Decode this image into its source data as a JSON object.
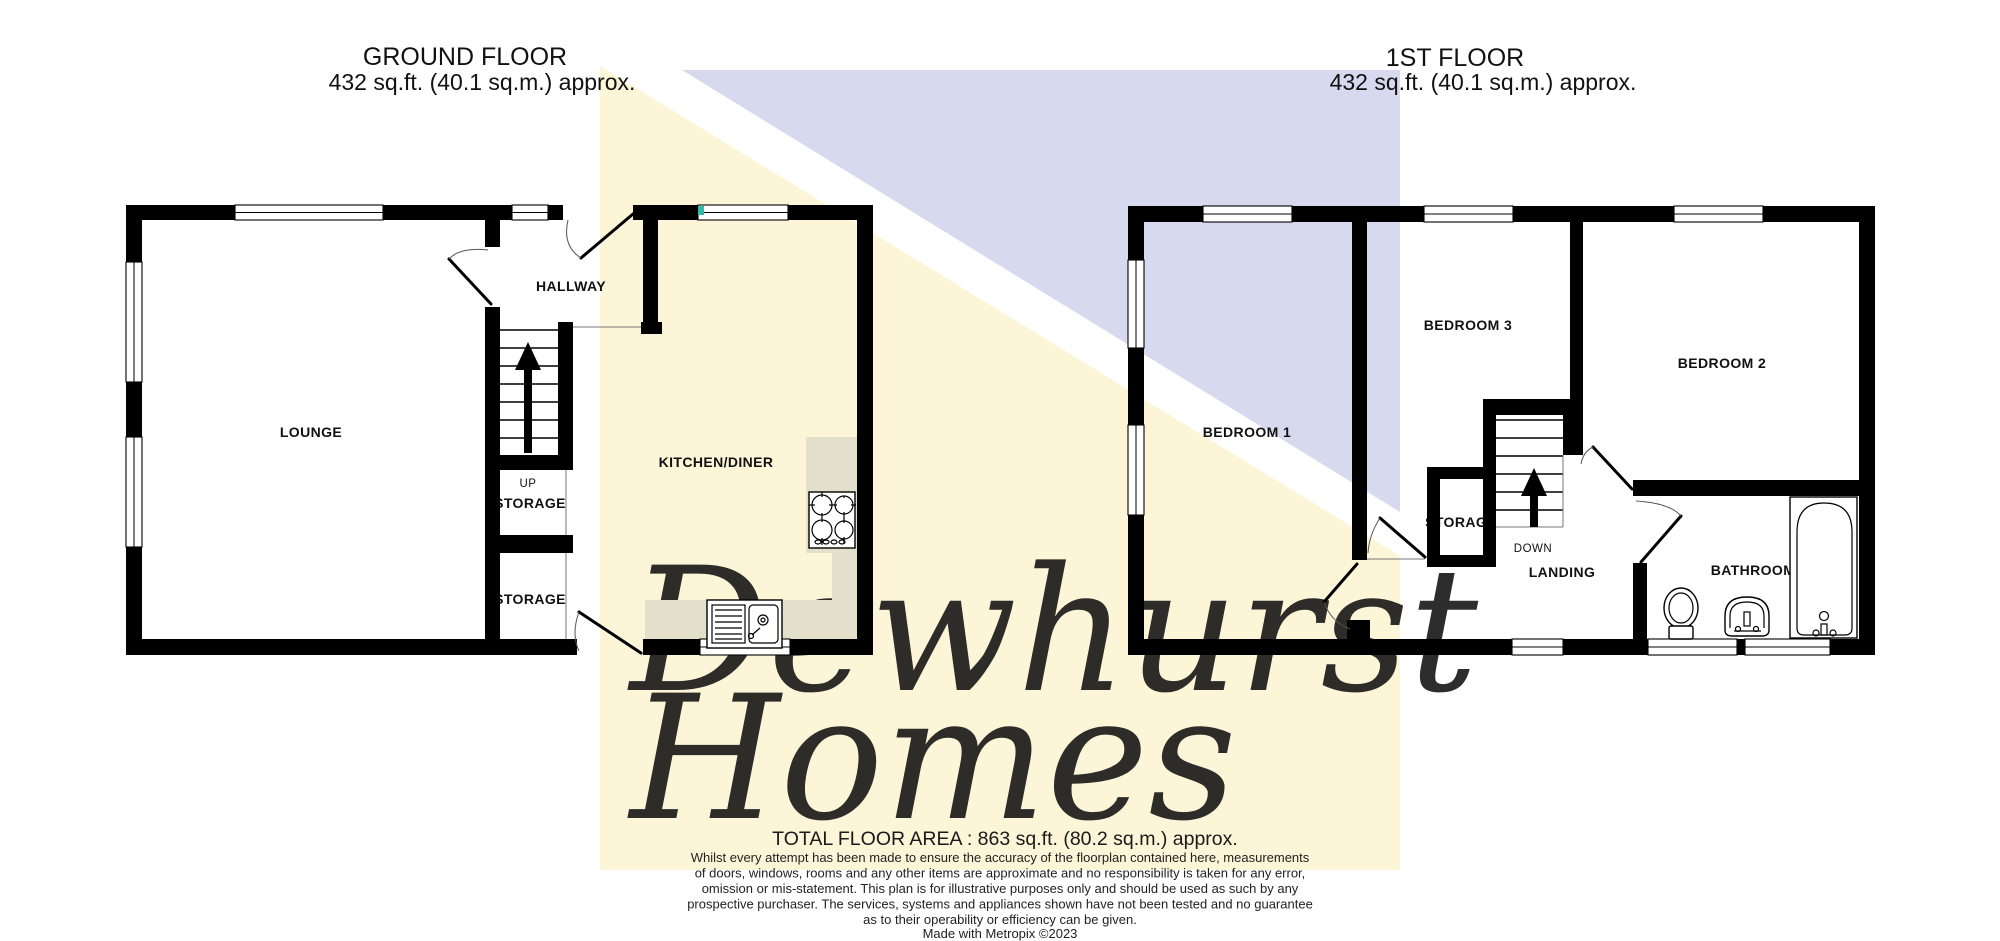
{
  "colors": {
    "yellow": "#fcf5d7",
    "lavender": "#d7daee",
    "watermark": "#c6cbe6",
    "counter": "#e2e0ca",
    "teal": "#35b8aa"
  },
  "titles": {
    "ground_title": "GROUND FLOOR",
    "ground_area": "432 sq.ft. (40.1 sq.m.) approx.",
    "first_title": "1ST FLOOR",
    "first_area": "432 sq.ft. (40.1 sq.m.) approx."
  },
  "watermark": {
    "line1": "Dewhurst",
    "line2": "Homes"
  },
  "ground_floor": {
    "lounge": "LOUNGE",
    "hallway": "HALLWAY",
    "kitchen_diner": "KITCHEN/DINER",
    "stairs_direction": "UP",
    "storage_under_stairs": "STORAGE",
    "storage_rear": "STORAGE"
  },
  "first_floor": {
    "bedroom1": "BEDROOM 1",
    "bedroom2": "BEDROOM 2",
    "bedroom3": "BEDROOM 3",
    "storage": "STORAGE",
    "stairs_direction": "DOWN",
    "landing": "LANDING",
    "bathroom": "BATHROOM"
  },
  "footer": {
    "total_area": "TOTAL FLOOR AREA : 863 sq.ft. (80.2 sq.m.) approx.",
    "disclaimer": [
      "Whilst every attempt has been made to ensure the accuracy of the floorplan contained here, measurements",
      "of doors, windows, rooms and any other items are approximate and no responsibility is taken for any error,",
      "omission or mis-statement. This plan is for illustrative purposes only and should be used as such by any",
      "prospective purchaser. The services, systems and appliances shown have not been tested and no guarantee",
      "as to their operability or efficiency can be given."
    ],
    "credit": "Made with Metropix ©2023"
  }
}
